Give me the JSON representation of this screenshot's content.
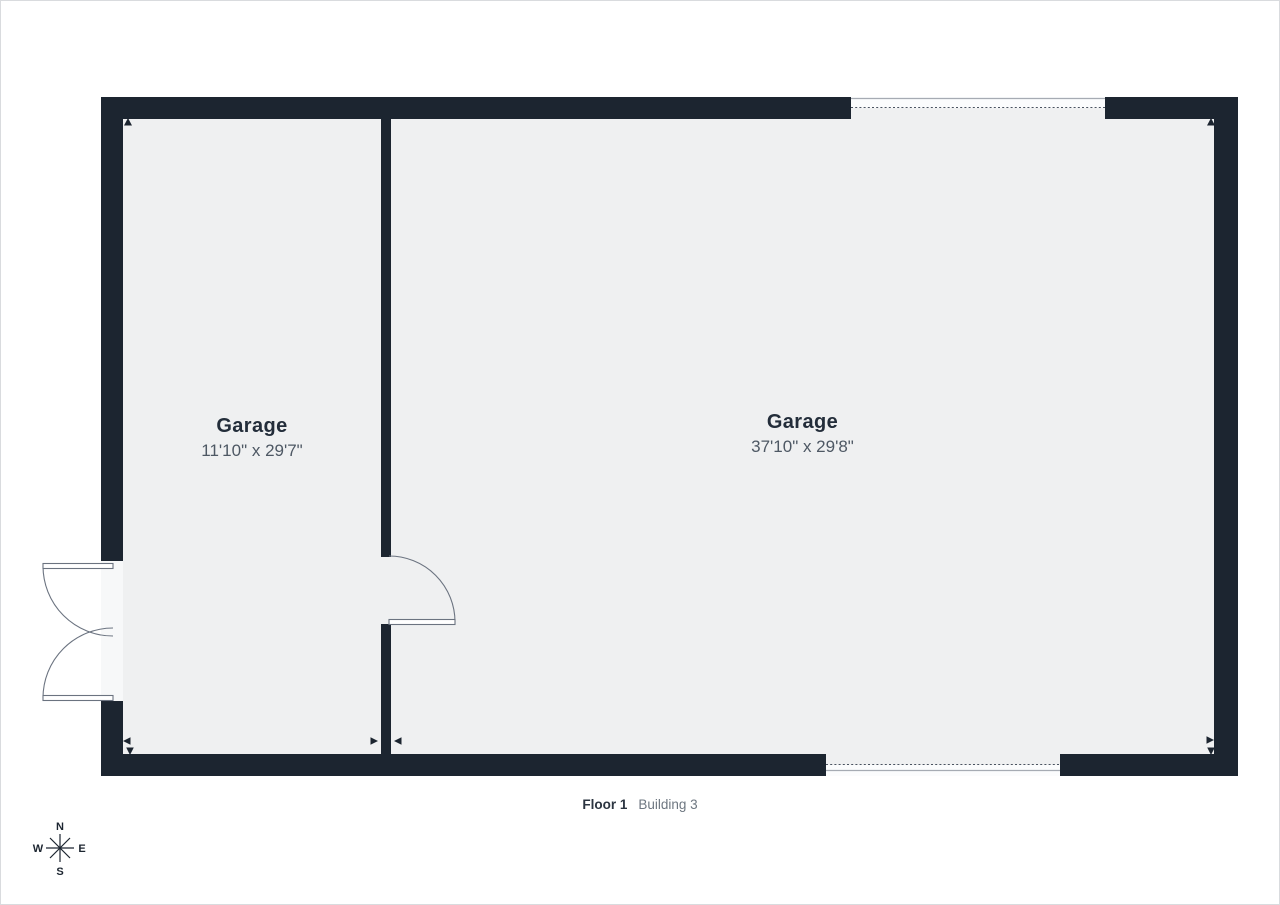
{
  "floorplan": {
    "rooms": [
      {
        "name": "Garage",
        "dims": "11'10\" x 29'7\""
      },
      {
        "name": "Garage",
        "dims": "37'10\" x 29'8\""
      }
    ],
    "caption": {
      "floor_label": "Floor 1",
      "building_label": "Building 3"
    },
    "compass": {
      "north": "N",
      "east": "E",
      "south": "S",
      "west": "W"
    },
    "colors": {
      "wall": "#1c2530",
      "floor": "#eff0f1",
      "line": "#6b7380"
    }
  }
}
